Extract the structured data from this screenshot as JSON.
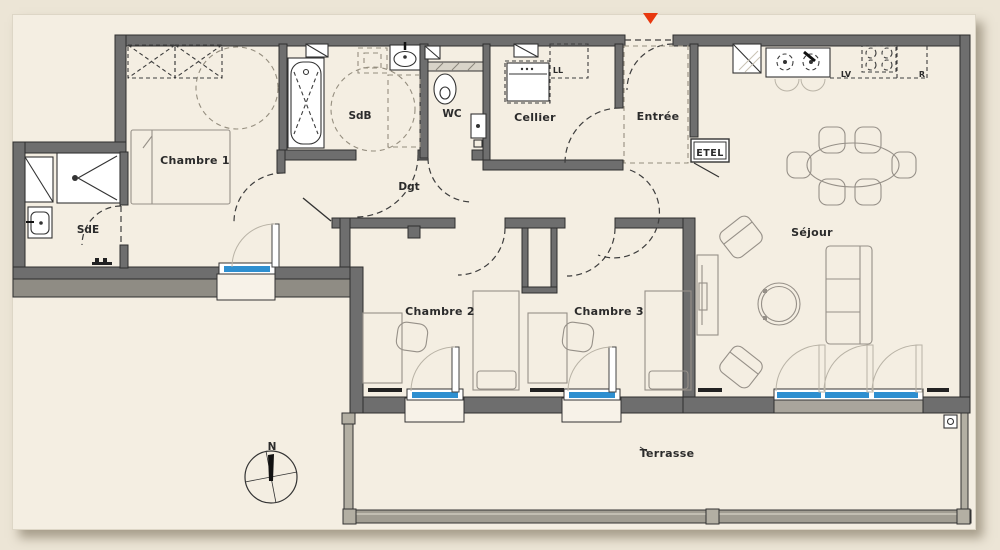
{
  "plan": {
    "title": "Plan d'appartement 4 pièces",
    "rooms": {
      "chambre1": "Chambre 1",
      "sdb": "SdB",
      "wc": "WC",
      "cellier": "Cellier",
      "entree": "Entrée",
      "sde": "SdE",
      "dgt": "Dgt",
      "chambre2": "Chambre 2",
      "chambre3": "Chambre 3",
      "sejour": "Séjour",
      "terrasse": "Terrasse"
    },
    "appliances": {
      "lave_linge": "LL",
      "lave_vaisselle": "LV",
      "refrigerateur": "R"
    },
    "closet": {
      "etel": "ETEL"
    },
    "compass": {
      "north": "N"
    },
    "colors": {
      "wall": "#6e6e6e",
      "window_glazing": "#2e8fd0",
      "entrance_marker": "#e8380f",
      "sheet": "#f4eee2",
      "page": "#ece5d6"
    }
  }
}
